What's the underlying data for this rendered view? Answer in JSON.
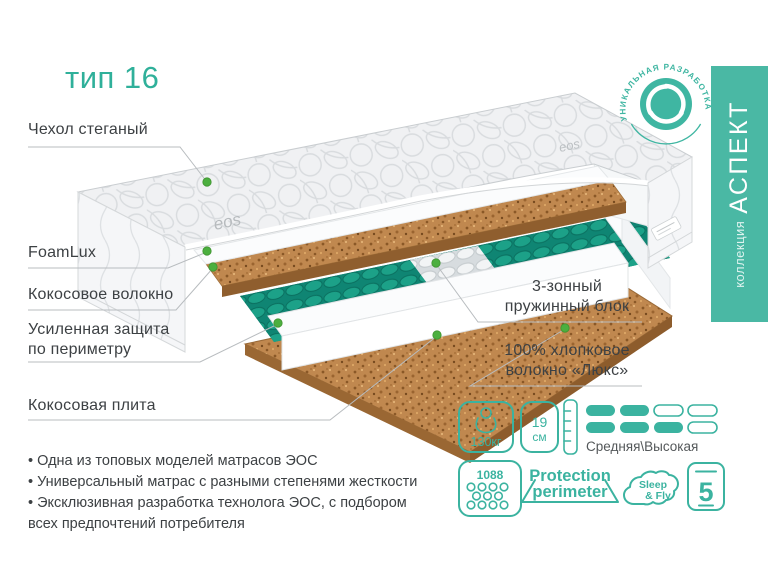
{
  "title": "тип 16",
  "colors": {
    "accent": "#3ab39e",
    "dot_green": "#4caf3f",
    "text": "#3d4144",
    "coco": "#c0884f",
    "spring_teal": "#17917e"
  },
  "badge": {
    "arc_text": "УНИКАЛЬНАЯ РАЗРАБОТКА"
  },
  "sidebar": {
    "collection": "коллекция",
    "name": "АСПЕКТ"
  },
  "callouts": {
    "cover": "Чехол стеганый",
    "foamlux": "FoamLux",
    "coco_fiber": "Кокосовое волокно",
    "perimeter": "Усиленная защита\nпо периметру",
    "coco_plate": "Кокосовая плита",
    "springs": "3-зонный\nпружинный блок",
    "cotton": "100% хлопковое\nволокно «Люкс»"
  },
  "features": [
    "Одна из топовых моделей матрасов ЭОС",
    "Универсальный матрас с разными степенями жесткости",
    "Эксклюзивная разработка технолога ЭОС, с подбором\nвсех предпочтений потребителя"
  ],
  "specs": {
    "weight": "130кг",
    "height_value": "19",
    "height_unit": "см",
    "firmness": "Средняя\\Высокая",
    "springs_count": "1088",
    "protection_1": "Protection",
    "protection_2": "perimeter",
    "brand_1": "Sleep",
    "brand_2": "& Fly",
    "warranty_years": "5"
  },
  "mattress": {
    "brand_logo": "eos"
  }
}
